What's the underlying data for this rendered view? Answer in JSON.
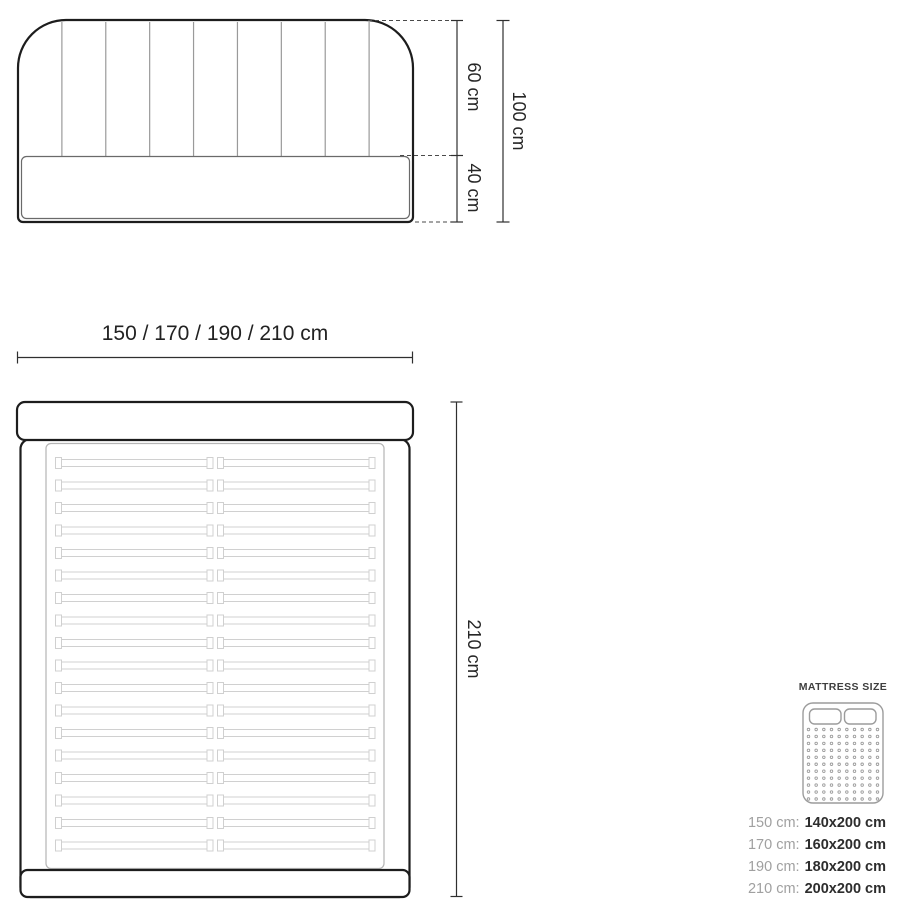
{
  "front_view": {
    "dim_upper": "60 cm",
    "dim_lower": "40 cm",
    "dim_total": "100 cm"
  },
  "width_dimension": {
    "label": "150 / 170 / 190 / 210 cm"
  },
  "top_view": {
    "dim_length": "210 cm",
    "slat_count": 18
  },
  "legend": {
    "title": "MATTRESS SIZE",
    "icon": {
      "name": "mattress-icon",
      "dot_cols": 10,
      "dot_rows": 11
    },
    "rows": [
      {
        "label": "150 cm:",
        "value": "140x200 cm"
      },
      {
        "label": "170 cm:",
        "value": "160x200 cm"
      },
      {
        "label": "190 cm:",
        "value": "180x200 cm"
      },
      {
        "label": "210 cm:",
        "value": "200x200 cm"
      }
    ]
  },
  "colors": {
    "background": "#ffffff",
    "outline_dark": "#1d1d1d",
    "line_gray": "#9a9a9a",
    "slat_gray": "#d0d0d0",
    "dim_text": "#262626",
    "legend_label_gray": "#a0a0a0",
    "legend_value_dark": "#2d2d2d"
  }
}
